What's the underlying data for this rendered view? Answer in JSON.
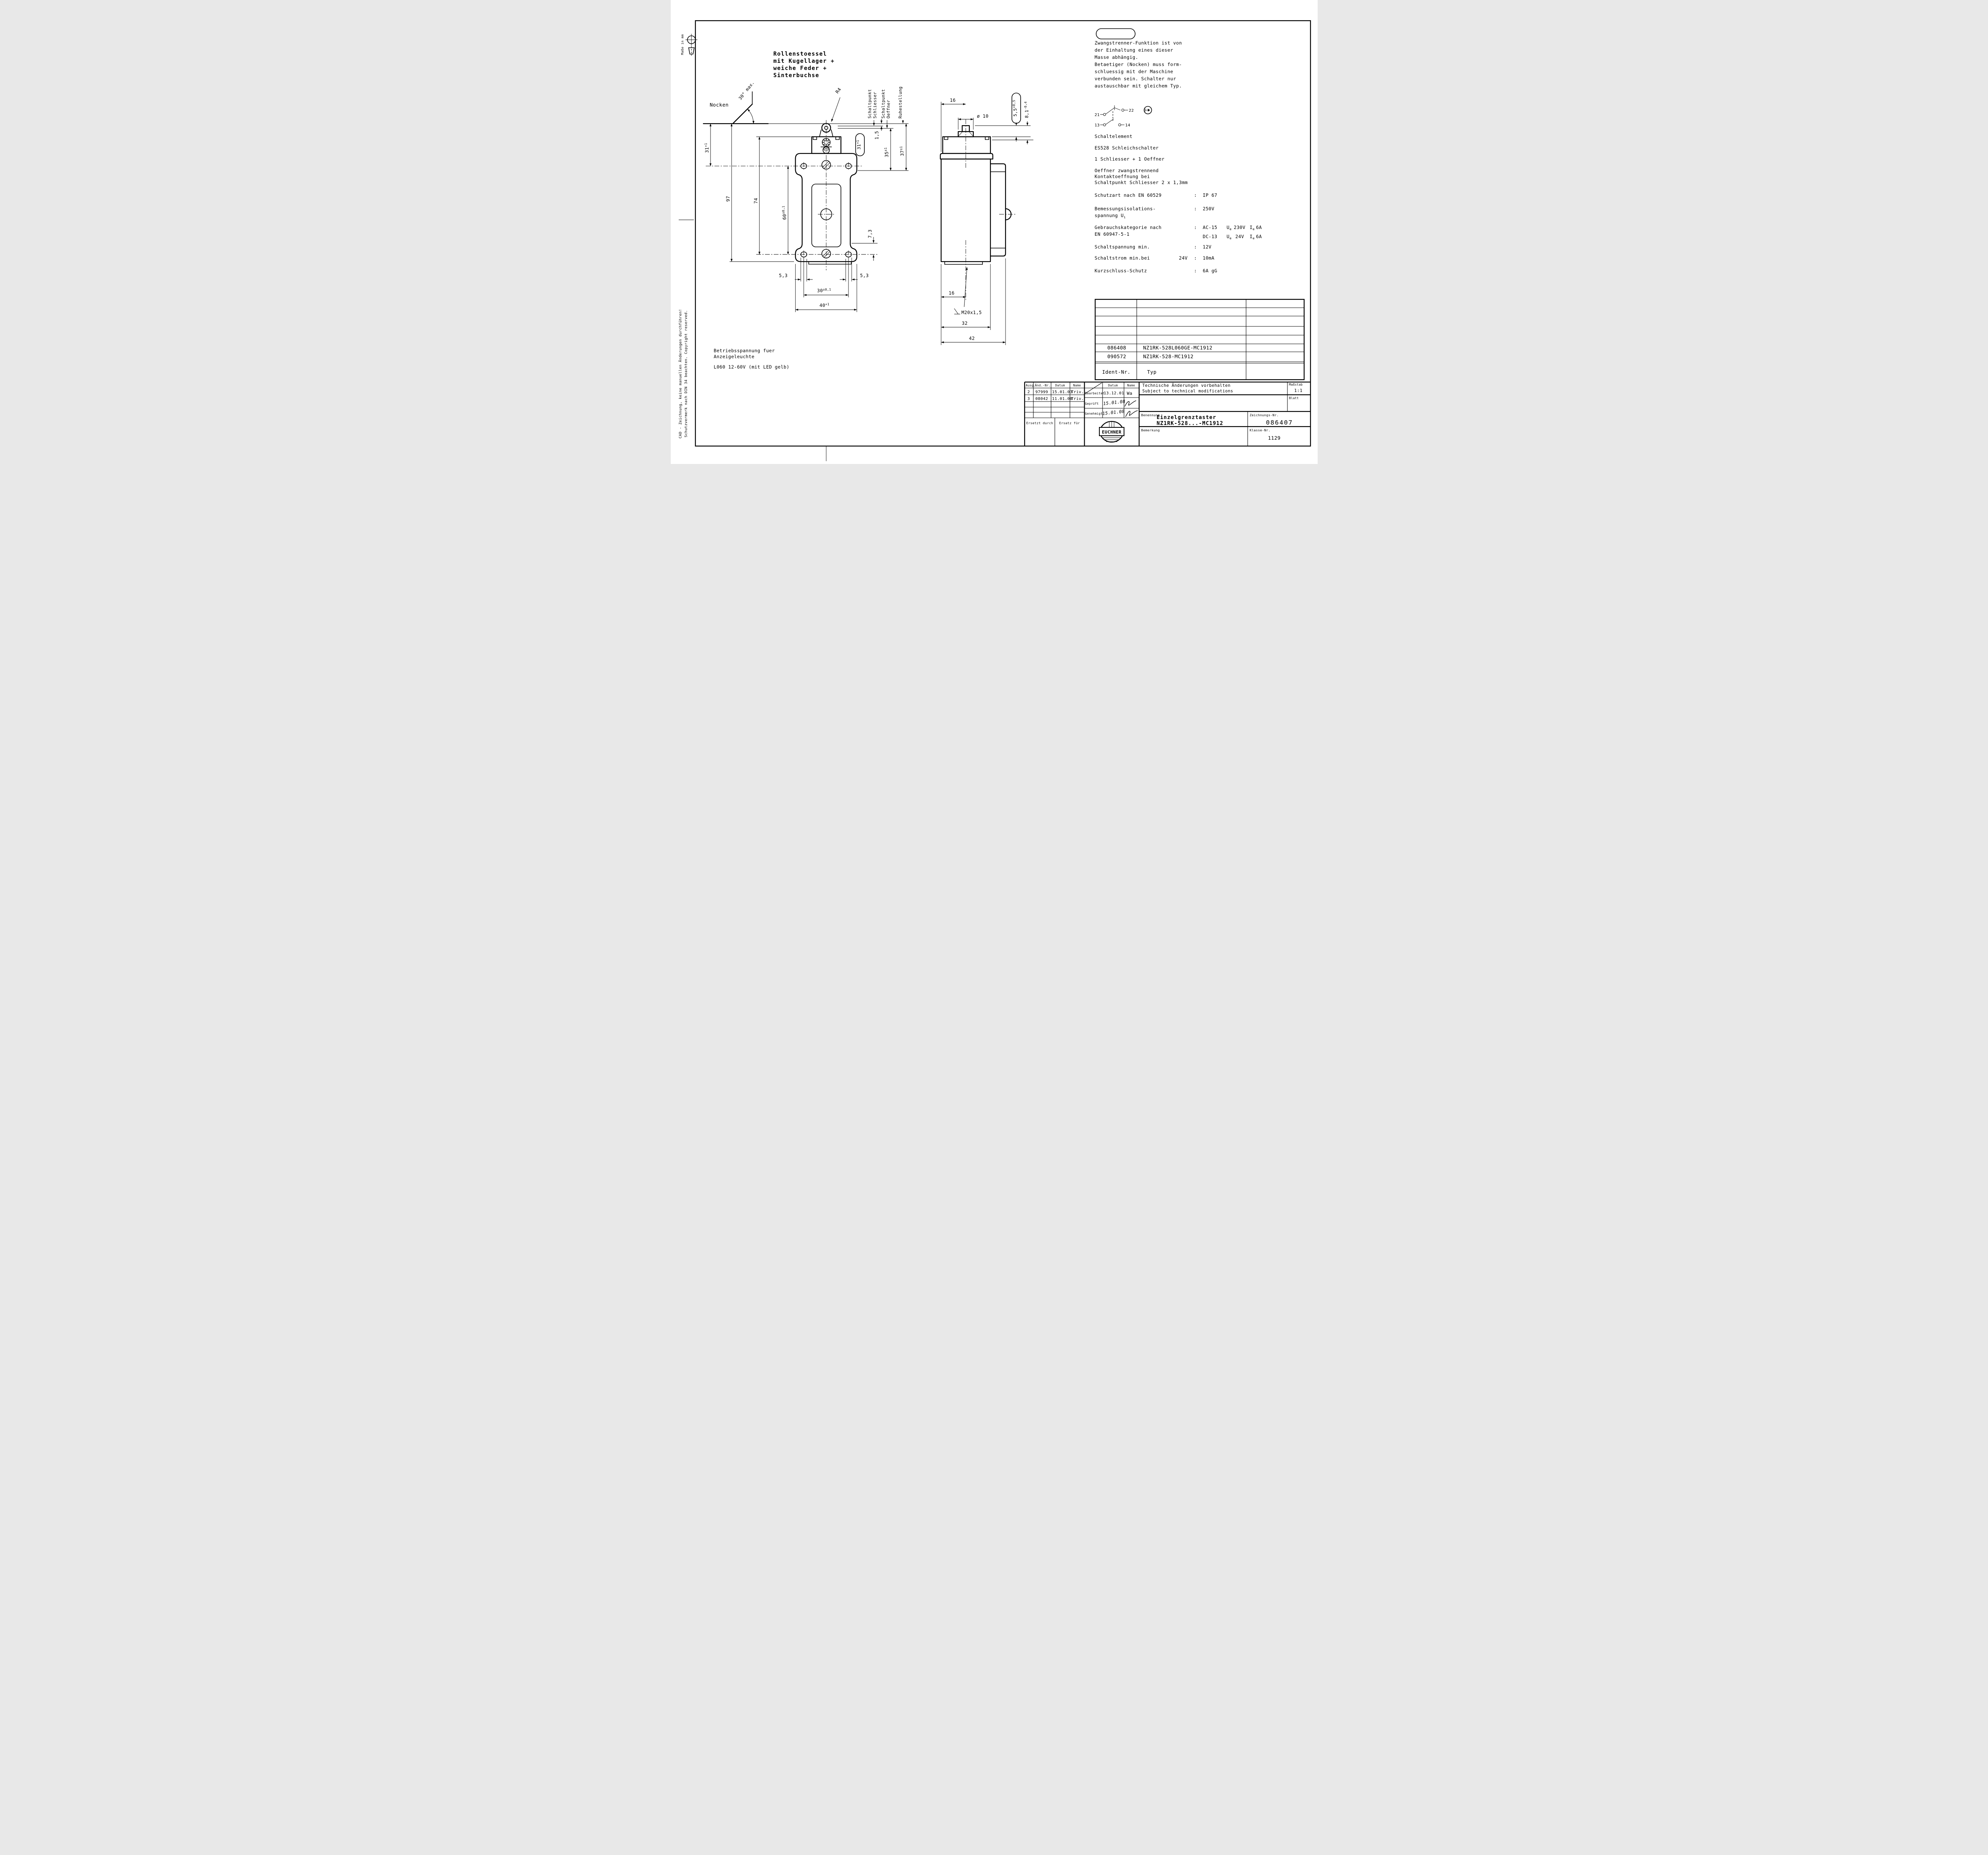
{
  "sheet": {
    "masse": "Maße in mm",
    "cad_note1": "CAD - Zeichnung, keine manuellen Änderungen durchführen!",
    "cad_note2": "Schutzvermerk nach DIN 34 beachten. Copyright reserved."
  },
  "actuator_note": {
    "l1": "Rollenstoessel",
    "l2": "mit Kugellager +",
    "l3": "weiche Feder +",
    "l4": "Sinterbuchse"
  },
  "view_labels": {
    "nocken": "Nocken",
    "angle": "30° max.",
    "radius": "R4",
    "sp1a": "Schaltpunkt",
    "sp1b": "Schliesser",
    "sp2a": "Schaltpunkt",
    "sp2b": "Oeffner",
    "ruhe": "Ruhestellung"
  },
  "dims": {
    "d31": {
      "v": "31",
      "t": "+1"
    },
    "d97": "97",
    "d74": "74",
    "d60": {
      "v": "60",
      "t": "±0,1"
    },
    "d73": "7,3",
    "d53l": "5,3",
    "d53r": "5,3",
    "d30": {
      "v": "30",
      "t": "±0,1"
    },
    "d40": {
      "v": "40",
      "t": "+1"
    },
    "d15": "1,5",
    "d35": {
      "v": "35",
      "t": "±1"
    },
    "d37": {
      "v": "37",
      "t": "±1"
    },
    "balloon31": {
      "v": "31",
      "t": "+1"
    },
    "s16top": "16",
    "dia10": "ø 10",
    "balloon55": {
      "v": "5,5",
      "t": "+0,5"
    },
    "d81": {
      "v": "8,1",
      "t": "-0,4"
    },
    "s16bot": "16",
    "m20": "M20x1,5",
    "s32": "32",
    "s42": "42"
  },
  "zwangstrenner": {
    "l1": "Zwangstrenner-Funktion ist von",
    "l2": "der Einhaltung eines dieser",
    "l3": "Masse abhängig.",
    "l4": "Betaetiger (Nocken) muss form-",
    "l5": "schluessig mit der Maschine",
    "l6": "verbunden sein. Schalter nur",
    "l7": "austauschbar mit gleichem Typ."
  },
  "schaltelement": {
    "t21": "21",
    "t22": "22",
    "t13": "13",
    "t14": "14",
    "title": "Schaltelement",
    "type": "ES528 Schleichschalter",
    "contacts": "1 Schliesser + 1 Oeffner",
    "note1": "Oeffner zwangstrennend",
    "note2": "Kontaktoeffnung bei",
    "note3": "Schaltpunkt Schliesser 2 x 1,3mm"
  },
  "specs": {
    "colon": ":",
    "schutzart_label": "Schutzart nach EN 60529",
    "schutzart_value": "IP 67",
    "bemessung_label1": "Bemessungsisolations-",
    "bemessung_label2": "spannung U",
    "bemessung_sub": "i",
    "bemessung_value": "250V",
    "gebrauch_label1": "Gebrauchskategorie nach",
    "gebrauch_label2": "EN 60947-5-1",
    "ac_cat": "AC-15",
    "ac_ue": "230V",
    "ac_ie": "6A",
    "dc_cat": "DC-13",
    "dc_ue": "24V",
    "dc_ie": "6A",
    "sym_u": "U",
    "sym_i": "I",
    "sym_e": "e",
    "schaltspannung_label": "Schaltspannung min.",
    "schaltspannung_value": "12V",
    "schaltstrom_label": "Schaltstrom min.bei",
    "schaltstrom_cond": "24V",
    "schaltstrom_value": "10mA",
    "kurzschluss_label": "Kurzschluss-Schutz",
    "kurzschluss_value": "6A gG"
  },
  "operating_voltage": {
    "l1": "Betriebsspannung fuer",
    "l2": "Anzeigeleuchte",
    "l3": "L060   12-60V  (mit LED gelb)"
  },
  "ident_table": {
    "row1_id": "086408",
    "row1_typ": "NZ1RK-528L060GE-MC1912",
    "row2_id": "090572",
    "row2_typ": "NZ1RK-528-MC1912",
    "header_id": "Ident-Nr.",
    "header_typ": "Typ"
  },
  "revision": {
    "h_ausg": "Ausg.",
    "h_aend": "Änd.-Nr.",
    "h_datum": "Datum",
    "h_name": "Name",
    "h_datum2": "Datum",
    "h_name2": "Name",
    "r2_ausg": "2",
    "r2_aend": "97999",
    "r2_datum": "15.01.03",
    "r2_name": "Triv.",
    "r3_ausg": "3",
    "r3_aend": "08042",
    "r3_datum": "11.01.08",
    "r3_name": "Triv.",
    "bearbeitet": "Bearbeitet",
    "bearbeitet_datum": "13.12.01",
    "bearbeitet_name": "Wa",
    "geprueft": "Geprüft",
    "geprueft_datum": "15.01.08",
    "genehmigt": "Genehmigt",
    "genehmigt_datum": "15.01.08",
    "ersetzt": "Ersetzt durch",
    "ersatz": "Ersatz für"
  },
  "title_block": {
    "tech1": "Technische Änderungen vorbehalten",
    "tech2": "Subject to technical modifications",
    "masstab_label": "Maßstab",
    "masstab": "1:1",
    "blatt_label": "Blatt",
    "benennung_label": "Benennung",
    "benennung1": "Einzelgrenztaster",
    "benennung2": "NZ1RK-528...-MC1912",
    "zeichnung_label": "Zeichnungs-Nr.",
    "zeichnung": "086407",
    "bemerkung_label": "Bemerkung",
    "klasse_label": "Klasse-Nr.",
    "klasse": "1129",
    "logo": "EUCHNER"
  }
}
